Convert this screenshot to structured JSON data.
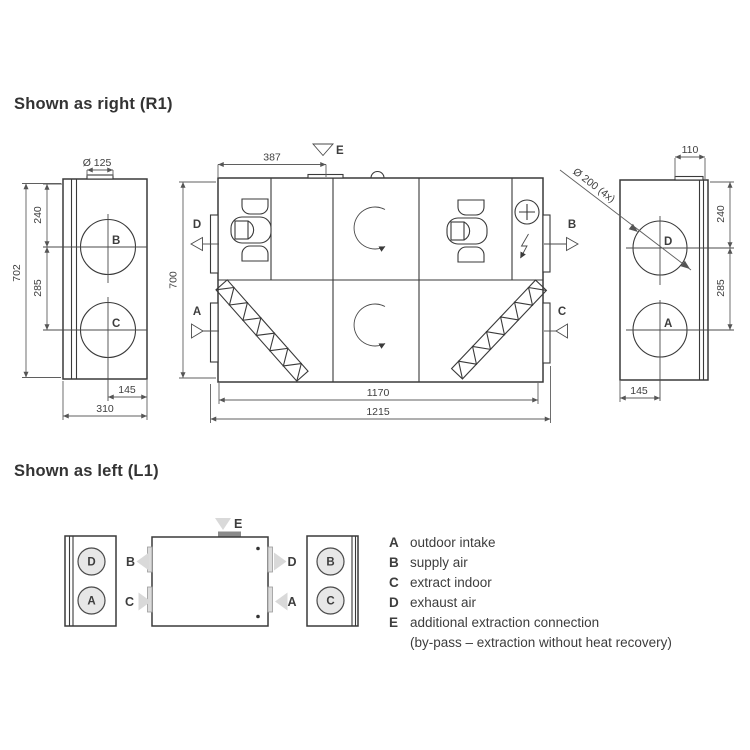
{
  "r1": {
    "title": "Shown as right (R1)",
    "left_view": {
      "dia_top": "Ø 125",
      "height": "702",
      "dim_240": "240",
      "dim_285": "285",
      "dim_145": "145",
      "width": "310",
      "port_top": "B",
      "port_bottom": "C"
    },
    "front_view": {
      "dim_387": "387",
      "height": "700",
      "width_inner": "1170",
      "width_outer": "1215",
      "label_e": "E",
      "label_d": "D",
      "label_a": "A",
      "label_b": "B",
      "label_c": "C"
    },
    "right_view": {
      "dim_110": "110",
      "dia_ports": "Ø 200 (4x)",
      "dim_240": "240",
      "dim_285": "285",
      "dim_145": "145",
      "port_top": "D",
      "port_bottom": "A"
    }
  },
  "l1": {
    "title": "Shown as left (L1)",
    "label_e": "E",
    "left_box": {
      "top": "D",
      "bottom": "A"
    },
    "unit": {
      "left_top": "B",
      "left_bottom": "C",
      "right_top": "D",
      "right_bottom": "A"
    },
    "right_box": {
      "top": "B",
      "bottom": "C"
    }
  },
  "legend": {
    "items": [
      {
        "key": "A",
        "text": "outdoor intake"
      },
      {
        "key": "B",
        "text": "supply air"
      },
      {
        "key": "C",
        "text": "extract indoor"
      },
      {
        "key": "D",
        "text": "exhaust air"
      },
      {
        "key": "E",
        "text": "additional extraction connection"
      },
      {
        "key": "",
        "text": "(by-pass – extraction without heat recovery)"
      }
    ]
  },
  "colors": {
    "line": "#3a3a3a",
    "dim": "#5f5f5f",
    "fill_light": "#d9d9d9",
    "fill_stub": "#8a8a8a"
  }
}
